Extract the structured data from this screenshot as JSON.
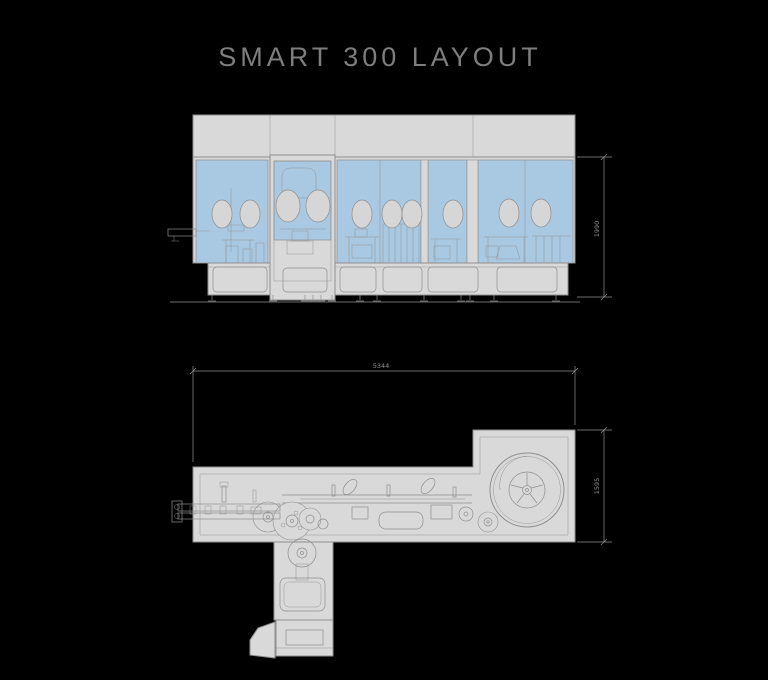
{
  "title": "SMART 300 LAYOUT",
  "theme": {
    "background": "#000000",
    "body_fill": "#d9d9d9",
    "outline": "#8f8f8f",
    "glass_blue": "#a9c8e1",
    "port_fill": "#d6d6d6",
    "dimension_color": "#919191",
    "title_color": "#7e7e7e"
  },
  "views": {
    "front_elevation": {
      "glove_port_count": 10,
      "dimension_height": "1990"
    },
    "plan": {
      "dimension_length": "5344",
      "dimension_depth": "1595"
    }
  }
}
